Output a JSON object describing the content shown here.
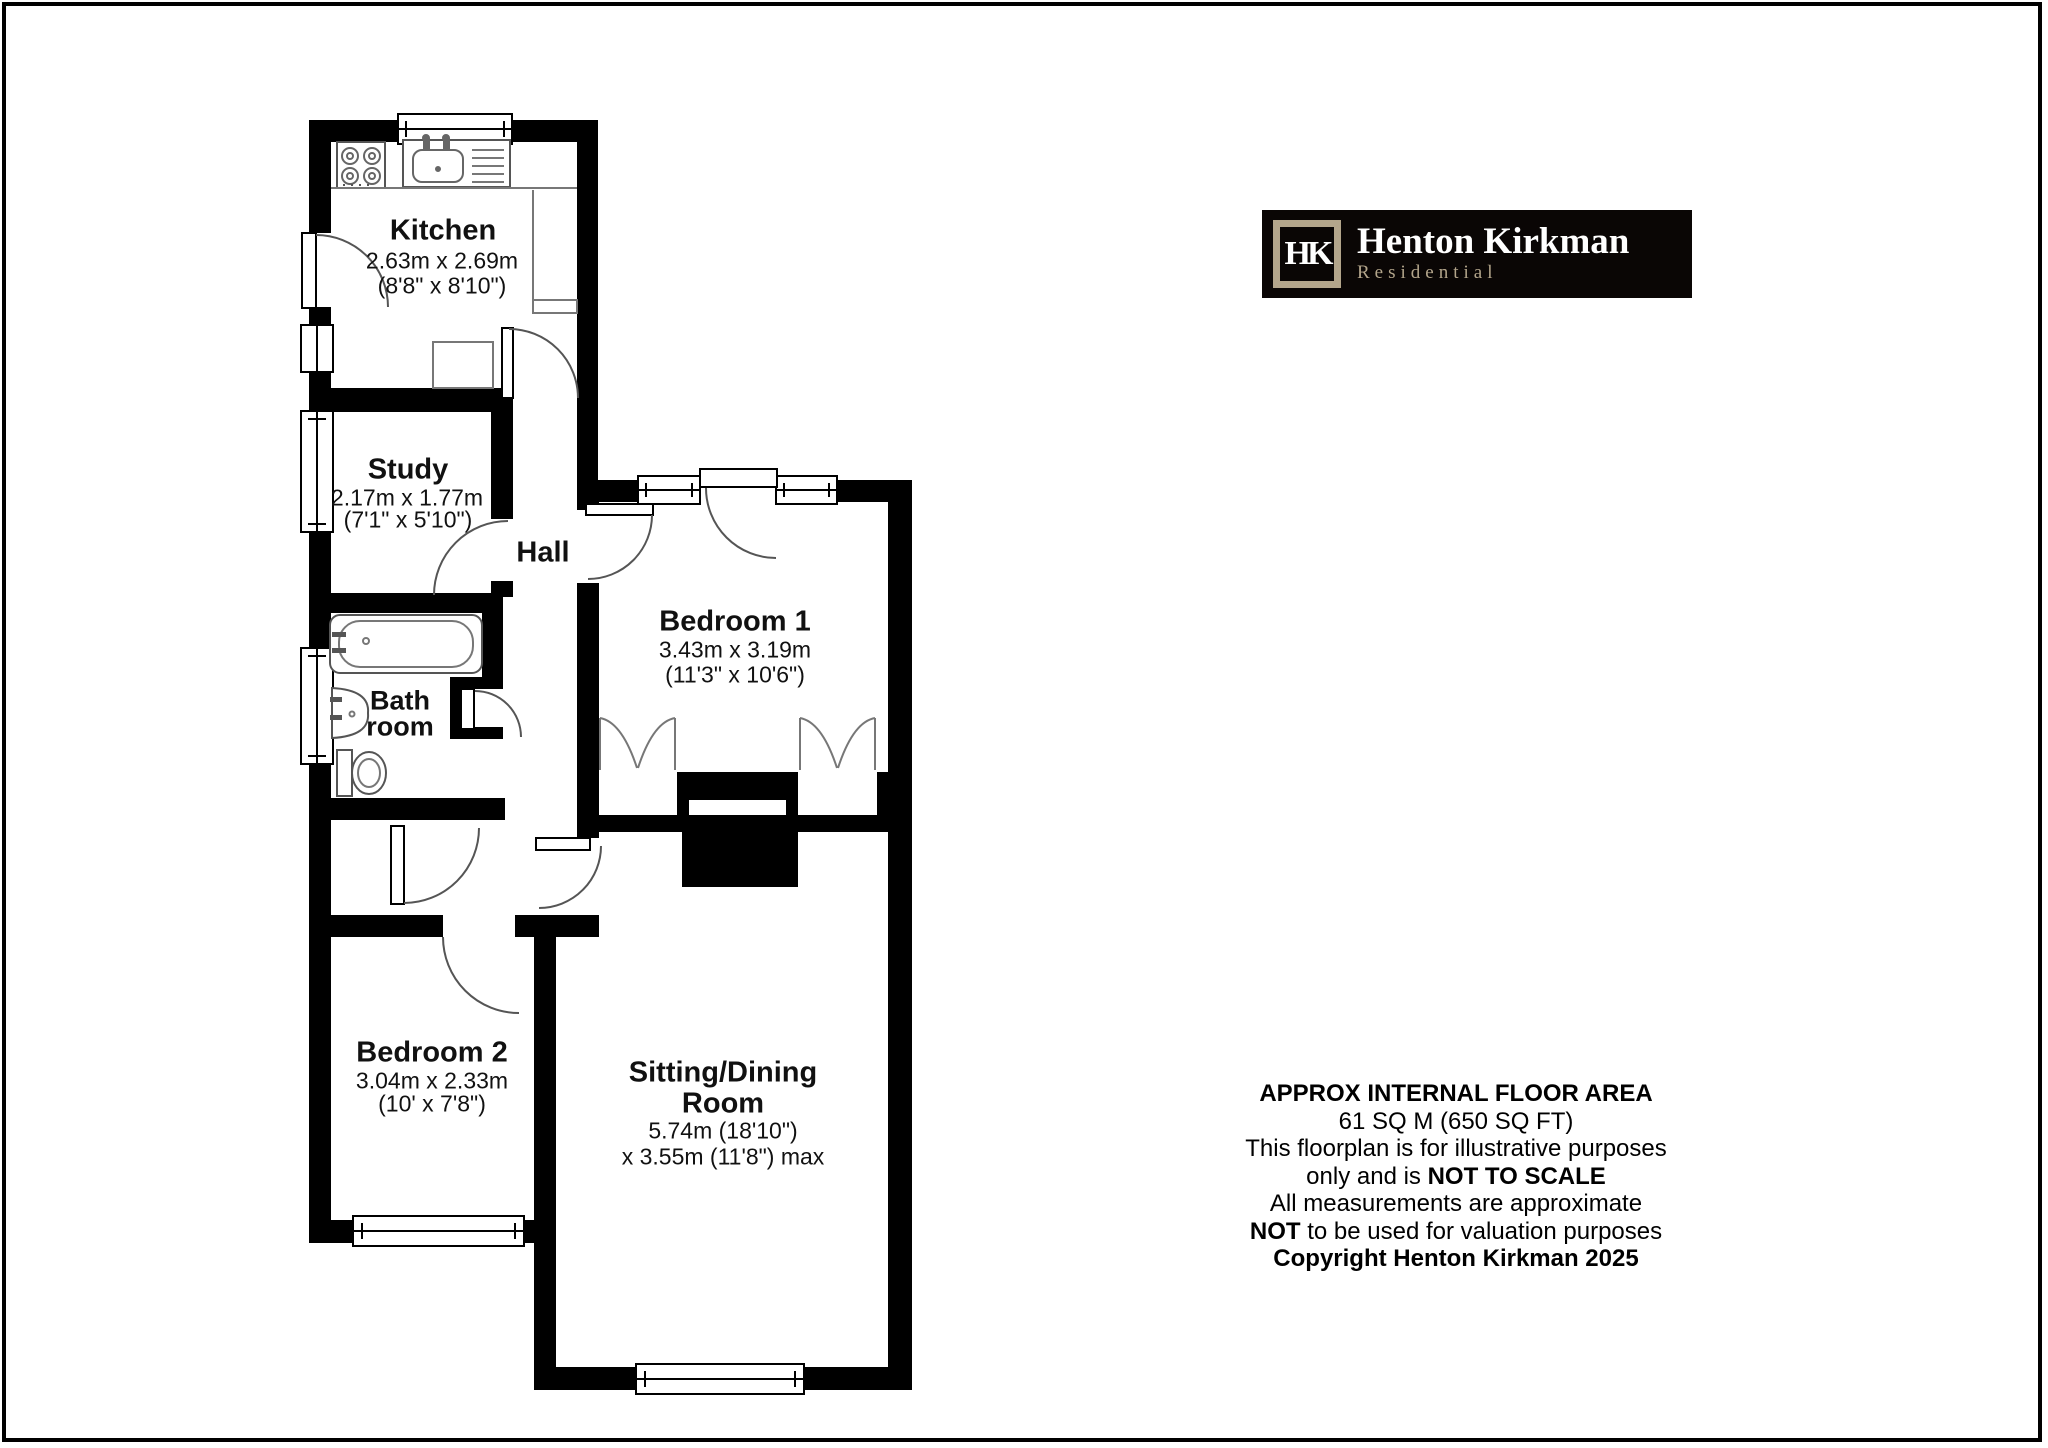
{
  "rooms": {
    "kitchen": {
      "name": "Kitchen",
      "dim1": "2.63m x 2.69m",
      "dim2": "(8'8\" x 8'10\")"
    },
    "study": {
      "name": "Study",
      "dim1": "2.17m x 1.77m",
      "dim2": "(7'1\" x 5'10\")"
    },
    "hall": {
      "name": "Hall"
    },
    "bathroom": {
      "name1": "Bath",
      "name2": "room"
    },
    "bedroom1": {
      "name": "Bedroom 1",
      "dim1": "3.43m x 3.19m",
      "dim2": "(11'3\" x 10'6\")"
    },
    "bedroom2": {
      "name": "Bedroom 2",
      "dim1": "3.04m x 2.33m",
      "dim2": "(10' x 7'8\")"
    },
    "sitting": {
      "name1": "Sitting/Dining",
      "name2": "Room",
      "dim1": "5.74m (18'10\")",
      "dim2": "x 3.55m (11'8\") max"
    }
  },
  "logo": {
    "monogram": "HK",
    "name": "Henton Kirkman",
    "tagline": "Residential",
    "bg_color": "#0a0605",
    "accent_color": "#b3a58b"
  },
  "disclaimer": {
    "line1": "APPROX INTERNAL FLOOR AREA",
    "line2": "61 SQ M (650 SQ FT)",
    "line3": "This floorplan is for illustrative purposes",
    "line4_pre": "only and is ",
    "line4_bold": "NOT TO SCALE",
    "line5": "All measurements are approximate",
    "line6_bold": "NOT",
    "line6_post": " to be used for valuation purposes",
    "line7": "Copyright Henton Kirkman 2025"
  }
}
